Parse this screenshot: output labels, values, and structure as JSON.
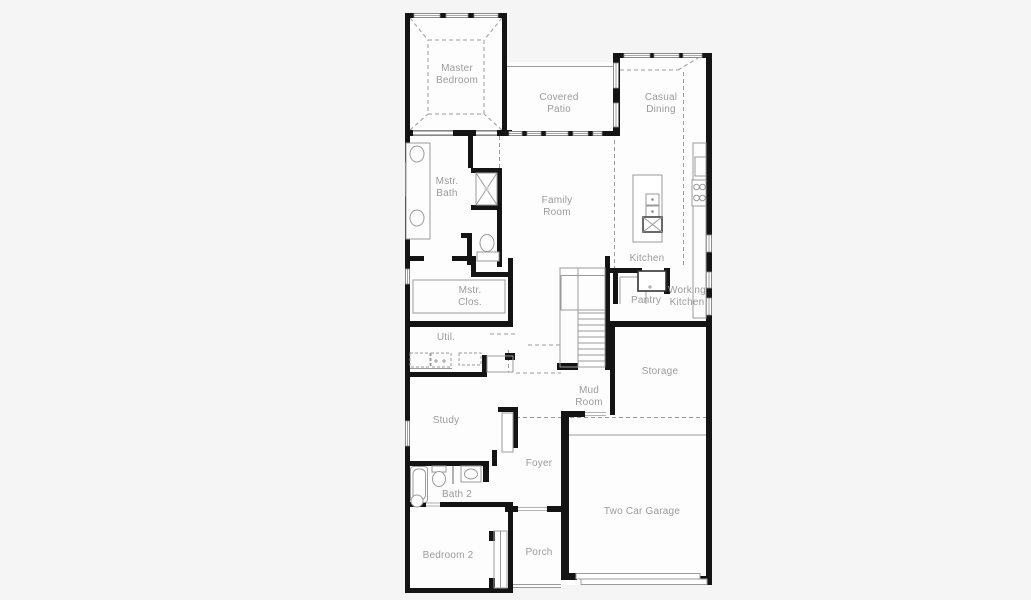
{
  "document": {
    "kind": "architectural floor plan",
    "floors_shown": 1
  },
  "colors": {
    "background": "#f5f5f6",
    "floor": "#fdfdfd",
    "wall": "#141414",
    "line": "#9a9a9a",
    "label": "#9b9b9b"
  },
  "rooms": {
    "master_bedroom": "Master\nBedroom",
    "covered_patio": "Covered\nPatio",
    "casual_dining": "Casual\nDining",
    "mstr_bath": "Mstr.\nBath",
    "family_room": "Family\nRoom",
    "kitchen": "Kitchen",
    "pantry": "Pantry",
    "working_kitchen": "Working\nKitchen",
    "mstr_clos": "Mstr.\nClos.",
    "util": "Util.",
    "storage": "Storage",
    "mud_room": "Mud\nRoom",
    "study": "Study",
    "foyer": "Foyer",
    "bath_2": "Bath 2",
    "bedroom_2": "Bedroom 2",
    "porch": "Porch",
    "two_car_garage": "Two Car Garage"
  }
}
